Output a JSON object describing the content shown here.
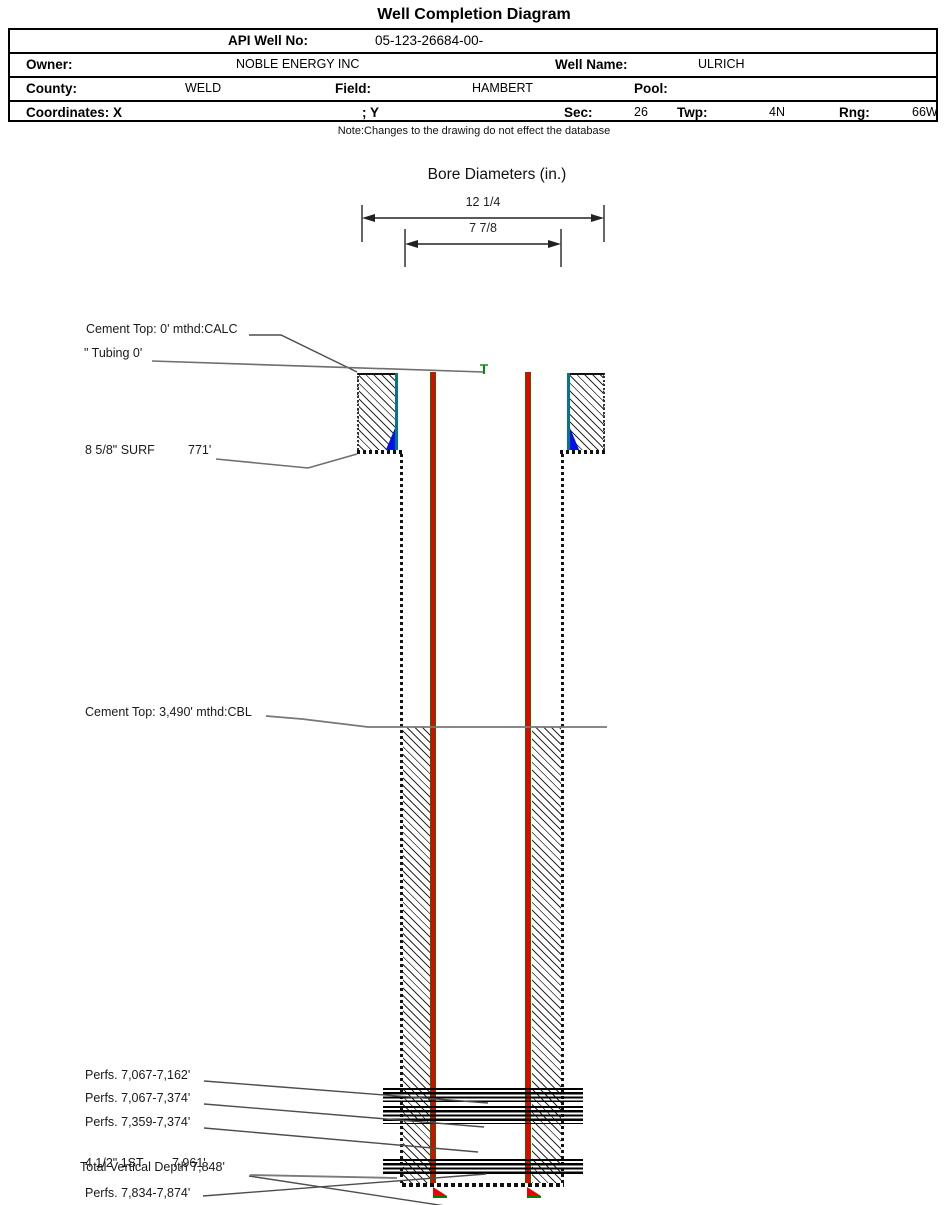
{
  "header": {
    "title": "Well Completion Diagram",
    "note": "Note:Changes to the drawing do not effect the database",
    "table": {
      "api_label": "API Well No:",
      "api_value": "05-123-26684-00-",
      "owner_label": "Owner:",
      "owner_value": "NOBLE ENERGY INC",
      "well_name_label": "Well Name:",
      "well_name_value": "ULRICH",
      "county_label": "County:",
      "county_value": "WELD",
      "field_label": "Field:",
      "field_value": "HAMBERT",
      "pool_label": "Pool:",
      "pool_value": "",
      "coordinates_label": "Coordinates: X",
      "coordinates_y_label": "; Y",
      "sec_label": "Sec:",
      "sec_value": "26",
      "twp_label": "Twp:",
      "twp_value": "4N",
      "rng_label": "Rng:",
      "rng_value": "66W"
    }
  },
  "bore_diameters": {
    "title": "Bore Diameters (in.)",
    "outer_label": "12 1/4",
    "inner_label": "7 7/8"
  },
  "labels": {
    "cement_top_surface": "Cement Top: 0' mthd:CALC",
    "tubing": "\" Tubing 0'",
    "surface_casing": "8 5/8\" SURF",
    "surface_casing_depth": "771'",
    "cement_top_production": "Cement Top: 3,490' mthd:CBL",
    "perfs_1": "Perfs. 7,067-7,162'",
    "perfs_2": "Perfs. 7,067-7,374'",
    "perfs_3": "Perfs. 7,359-7,374'",
    "production_casing": "4 1/2\" 1ST",
    "production_casing_depth": "7,961'",
    "total_vertical_depth": "Total Vertical Depth 7,848'",
    "perfs_4": "Perfs. 7,834-7,874'"
  },
  "colors": {
    "tubing_red": "#ee0000",
    "casing_green": "#008000",
    "surface_casing_teal": "#00788c",
    "cement_shoe_blue": "#0011ee",
    "leader_gray": "#757575",
    "leader_dark": "#4d4d4d"
  }
}
